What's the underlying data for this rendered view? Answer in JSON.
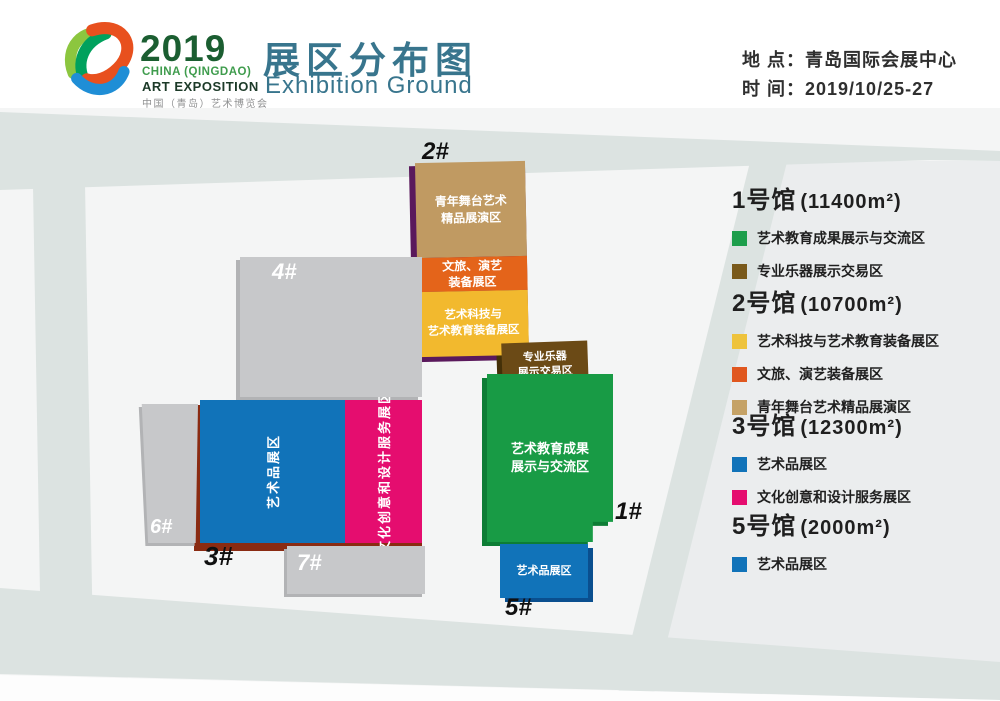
{
  "header": {
    "logo": {
      "year": "2019",
      "subtitle1": "CHINA (QINGDAO)",
      "subtitle2": "ART EXPOSITION",
      "subtitle3": "中国（青岛）艺术博览会"
    },
    "title_cn": "展区分布图",
    "title_en": "Exhibition Ground",
    "location": "地 点：青岛国际会展中心",
    "time": "时 间：2019/10/25-27"
  },
  "map": {
    "labels": {
      "h1": "1#",
      "h2": "2#",
      "h3": "3#",
      "h4": "4#",
      "h5": "5#",
      "h6": "6#",
      "h7": "7#"
    },
    "zones": {
      "youth_stage": "青年舞台艺术\n精品展演区",
      "culture_tour": "文旅、演艺\n装备展区",
      "art_tech": "艺术科技与\n艺术教育装备展区",
      "instruments": "专业乐器\n展示交易区",
      "art_edu": "艺术教育成果\n展示与交流区",
      "art_goods": "艺术品展区",
      "cultural_creative": "文化创意和设计服务展区"
    }
  },
  "legend": {
    "halls": [
      {
        "name": "1号馆",
        "area": "(11400m²)",
        "items": [
          {
            "color": "#1d9e4b",
            "label": "艺术教育成果展示与交流区"
          },
          {
            "color": "#7a5a1b",
            "label": "专业乐器展示交易区"
          }
        ]
      },
      {
        "name": "2号馆",
        "area": "(10700m²)",
        "items": [
          {
            "color": "#eec33c",
            "label": "艺术科技与艺术教育装备展区"
          },
          {
            "color": "#e0571f",
            "label": "文旅、演艺装备展区"
          },
          {
            "color": "#c5a266",
            "label": "青年舞台艺术精品展演区"
          }
        ]
      },
      {
        "name": "3号馆",
        "area": "(12300m²)",
        "items": [
          {
            "color": "#1173b9",
            "label": "艺术品展区"
          },
          {
            "color": "#e50d6f",
            "label": "文化创意和设计服务展区"
          }
        ]
      },
      {
        "name": "5号馆",
        "area": "(2000m²)",
        "items": [
          {
            "color": "#1173b9",
            "label": "艺术品展区"
          }
        ]
      }
    ]
  },
  "colors": {
    "tan": "#c09a62",
    "orange": "#e4641a",
    "yellow": "#f2b92e",
    "purple_edge": "#5a195c",
    "brown": "#6b4a16",
    "brown_edge": "#443008",
    "green": "#189b45",
    "green_edge": "#0d7d35",
    "blue": "#1173b9",
    "blue_edge": "#0a4f8f",
    "magenta": "#e50d6f",
    "red_edge": "#8a2b12",
    "gray_block": "#c7c8ca",
    "gray_edge": "#b2b3b5",
    "road": "#dce3e1",
    "panel": "#ebedee",
    "base": "#f4f5f5",
    "bottom_white": "#fdfdfd",
    "title_teal": "#38758d",
    "logo_green_dark": "#1b5e31",
    "logo_green": "#3f9c4d",
    "logo_dark": "#1c3a28"
  }
}
